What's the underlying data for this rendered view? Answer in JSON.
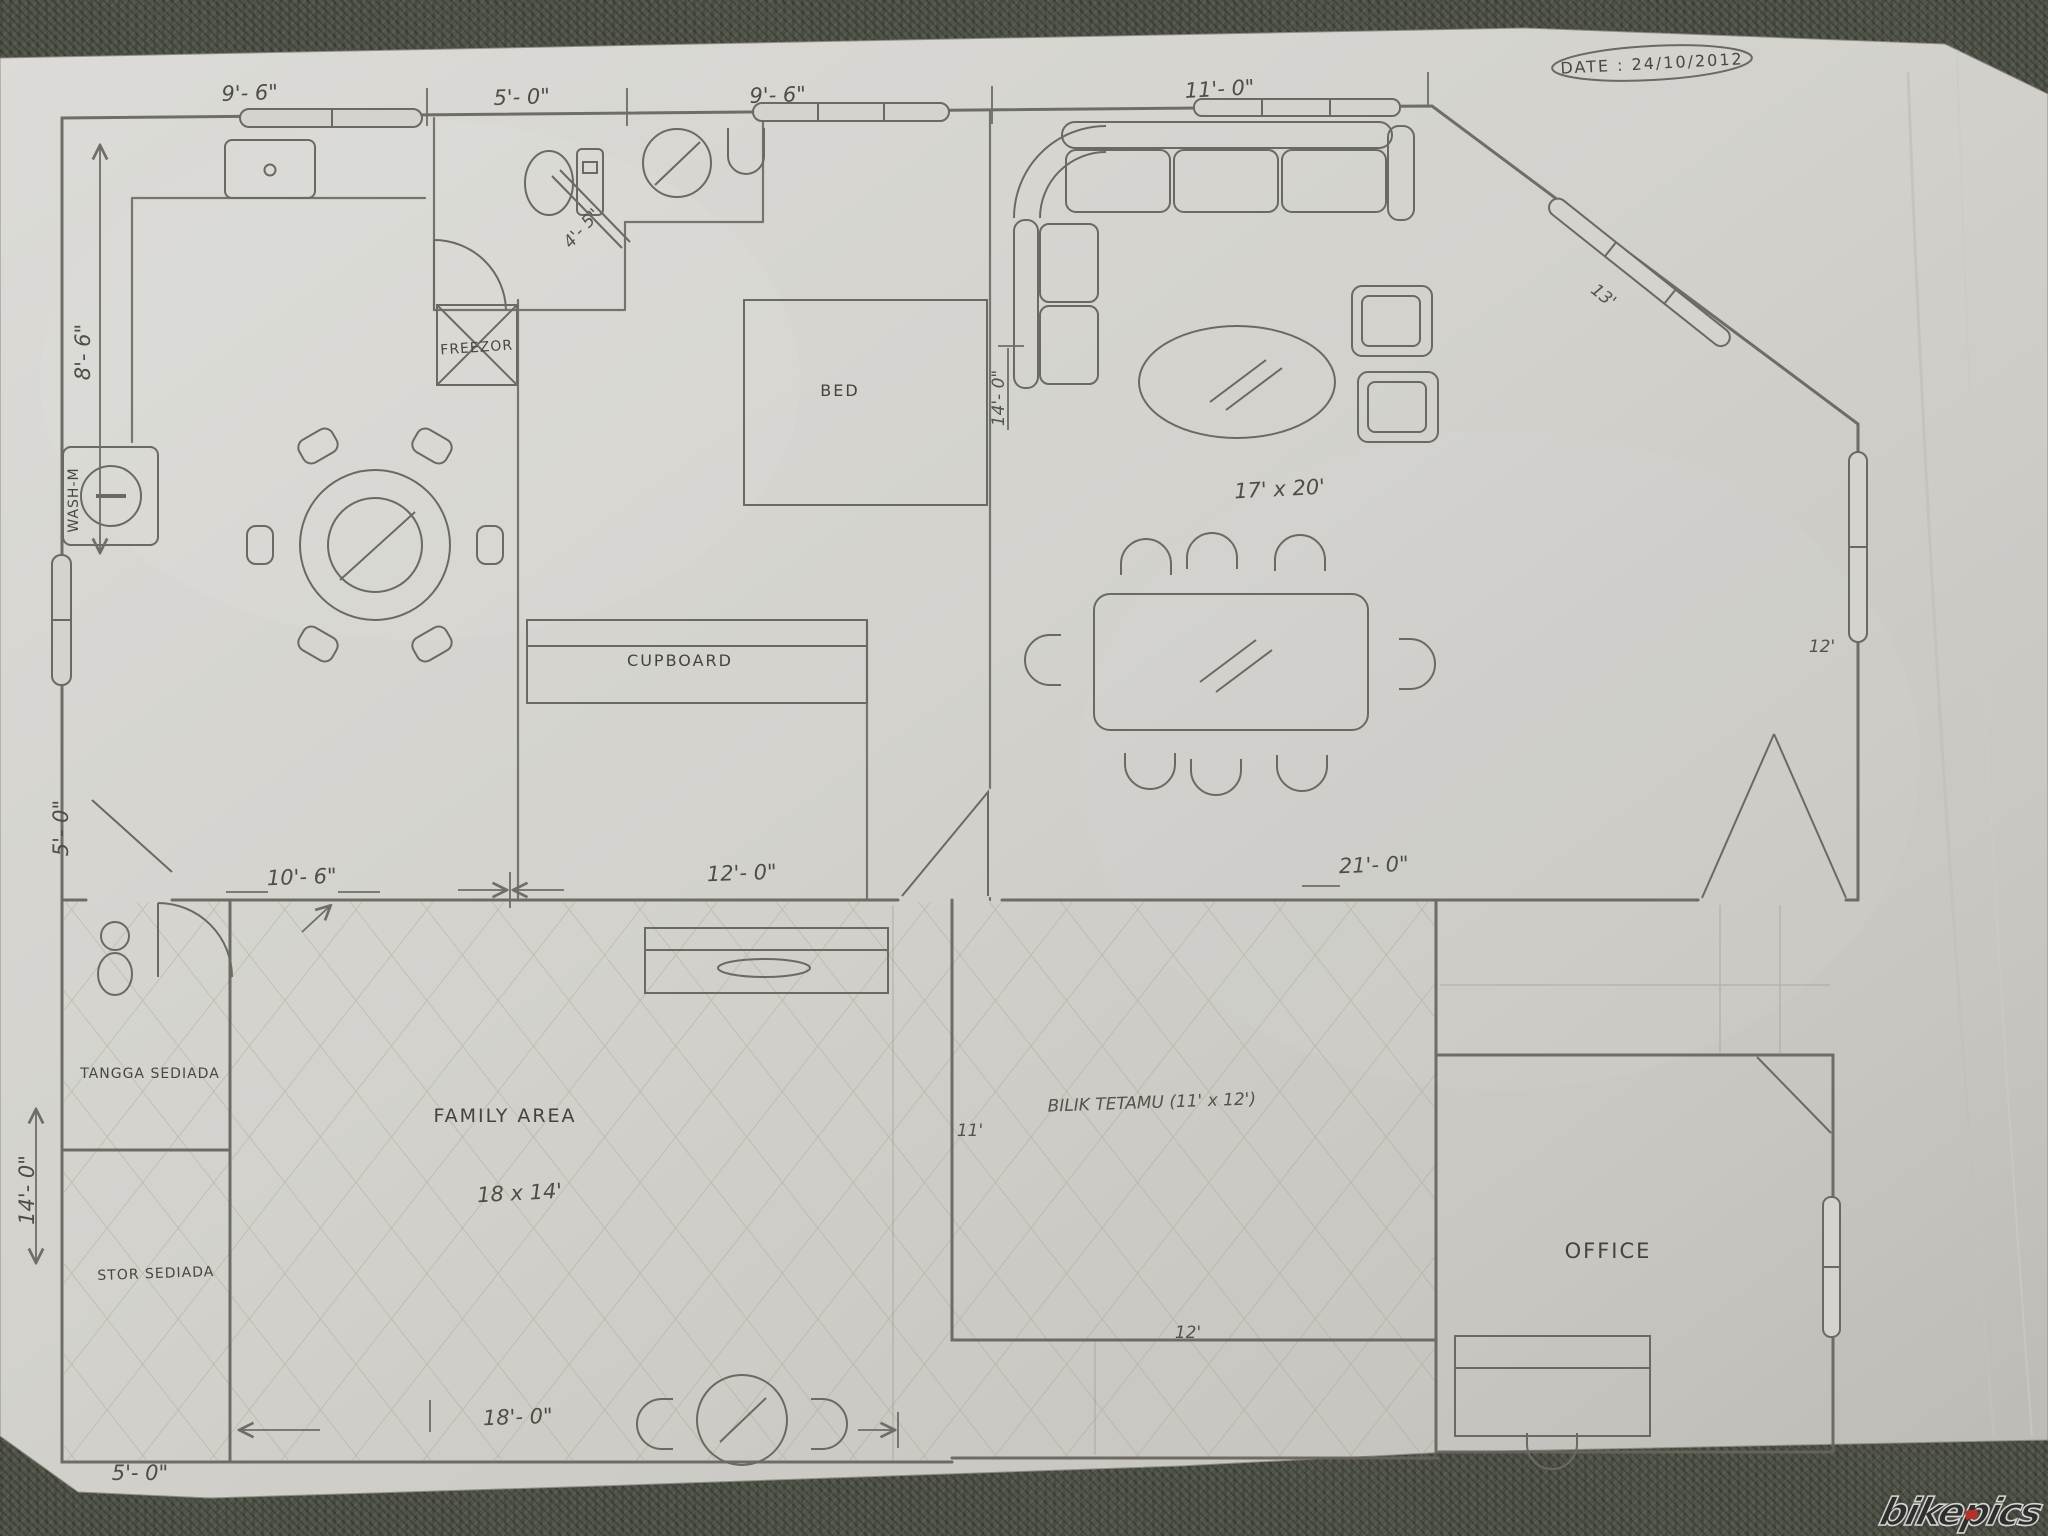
{
  "photo": {
    "date_stamp": "DATE : 24/10/2012",
    "watermark": "bikepics"
  },
  "upper_plan": {
    "dims": {
      "top_1": "9'- 6\"",
      "top_2": "5'- 0\"",
      "top_3": "9'- 6\"",
      "top_4": "11'- 0\"",
      "left_height": "8'- 6\"",
      "left_door": "5'- 0\"",
      "bath": "4'- 5\"",
      "bed_wall": "14'- 0\"",
      "mid_1": "10'- 6\"",
      "mid_2": "12'- 0\"",
      "mid_3": "21'- 0\"",
      "diag_window": "13'",
      "right_window": "12'"
    },
    "labels": {
      "washing_machine": "WASH-M",
      "freezer": "FREEZOR",
      "bed": "BED",
      "cupboard": "CUPBOARD",
      "living_size": "17' x 20'"
    }
  },
  "lower_plan": {
    "dims": {
      "left_height": "14'- 0\"",
      "bottom_width": "18'- 0\"",
      "bottom_left": "5'- 0\"",
      "guest_left": "11'",
      "guest_bottom": "12'"
    },
    "labels": {
      "stairs_room": "TANGGA SEDIADA",
      "store_room": "STOR SEDIADA",
      "family_area": "FAMILY AREA",
      "family_size": "18 x 14'",
      "guest_room": "BILIK TETAMU (11' x 12')",
      "office": "OFFICE"
    }
  }
}
